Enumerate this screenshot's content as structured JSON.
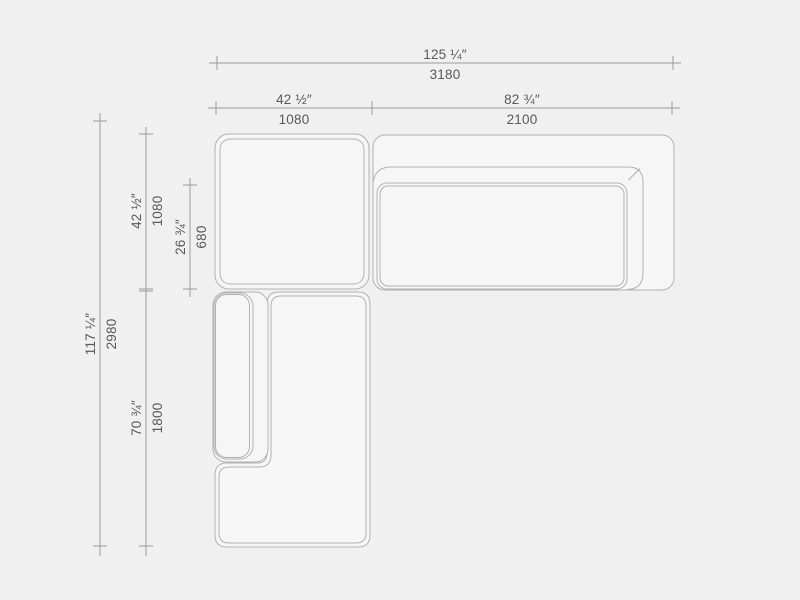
{
  "colors": {
    "bg": "#f0f0f0",
    "module-fill": "#f6f6f6",
    "sofa-line": "#b2b2b2",
    "dim-line": "#9a9a9a",
    "text": "#595959"
  },
  "dimensions": {
    "width_total": {
      "inches": "125 ¼″",
      "mm": "3180"
    },
    "width_left_module": {
      "inches": "42 ½″",
      "mm": "1080"
    },
    "width_right_module": {
      "inches": "82 ¾″",
      "mm": "2100"
    },
    "depth_total": {
      "inches": "117 ¼″",
      "mm": "2980"
    },
    "depth_top_module": {
      "inches": "42 ½″",
      "mm": "1080"
    },
    "depth_seat": {
      "inches": "26 ¾″",
      "mm": "680"
    },
    "depth_bottom_module": {
      "inches": "70 ¾″",
      "mm": "1800"
    }
  }
}
